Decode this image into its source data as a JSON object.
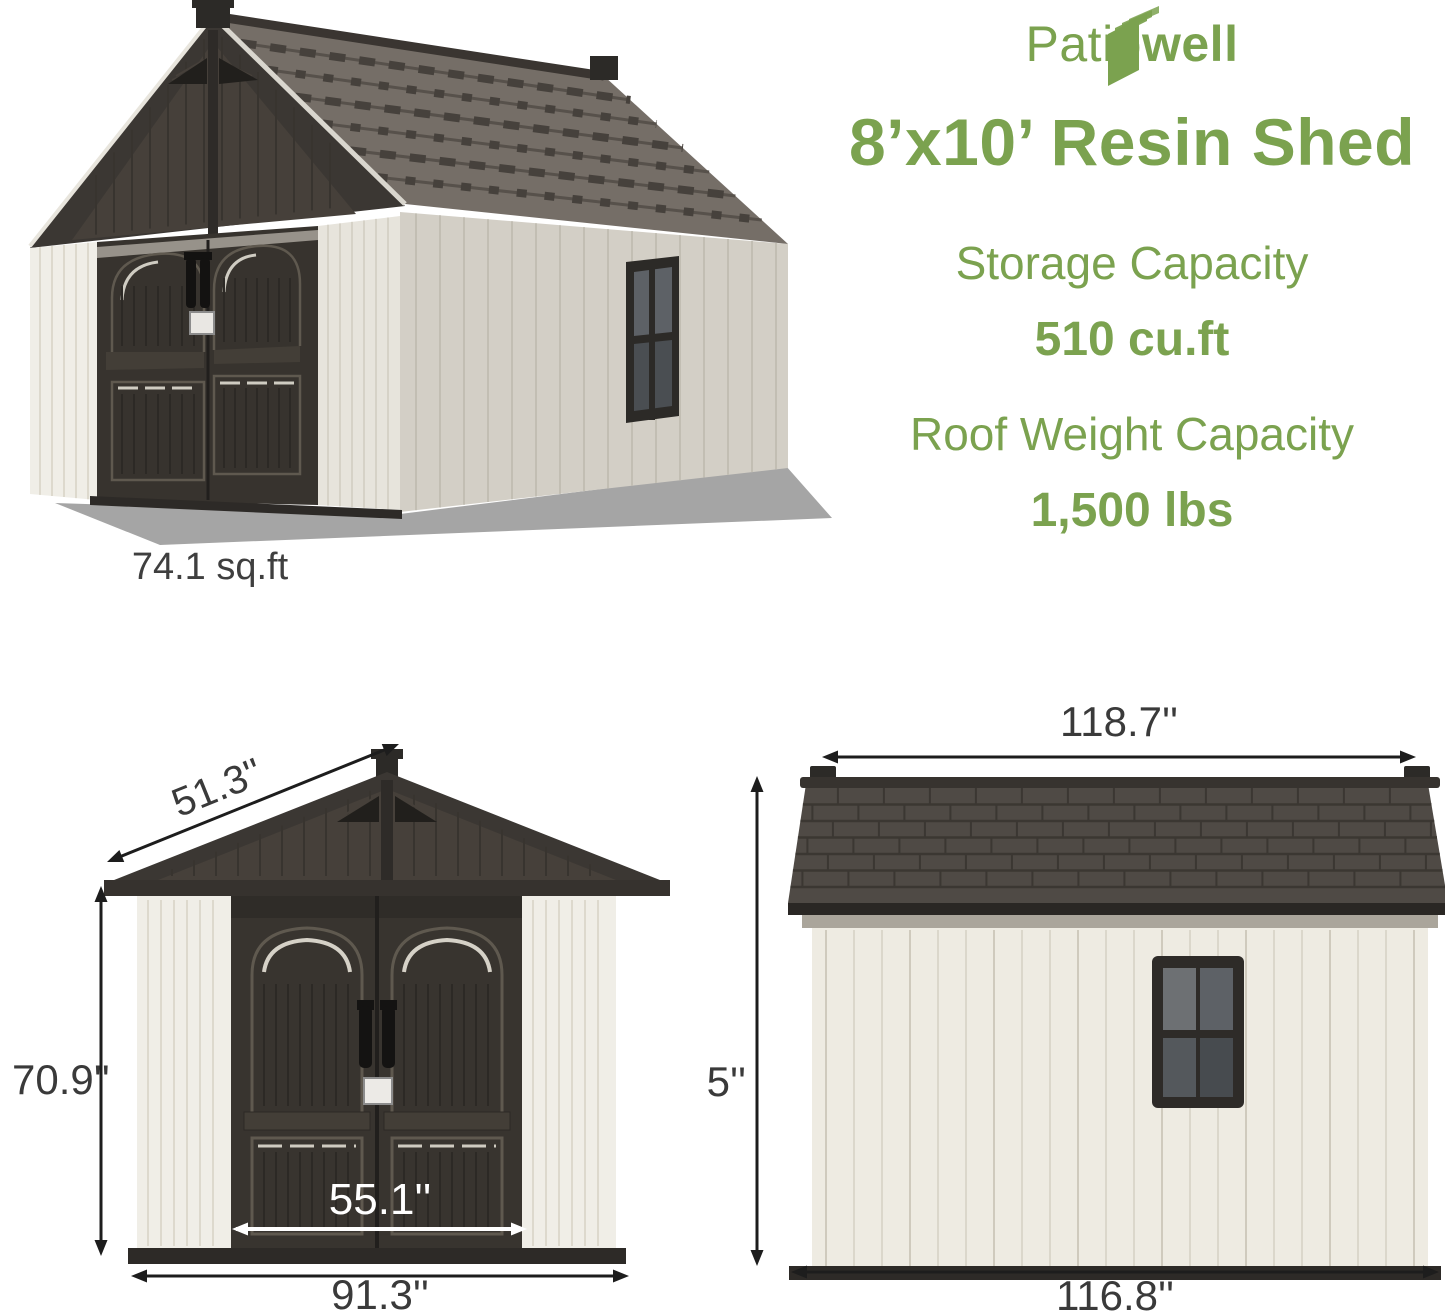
{
  "brand": {
    "name_part1": "Patio",
    "name_part2": "well",
    "logo_icon": "book-pages-icon"
  },
  "header": {
    "title": "8’x10’ Resin Shed"
  },
  "specs": {
    "storage_label": "Storage Capacity",
    "storage_value": "510 cu.ft",
    "roof_label": "Roof Weight Capacity",
    "roof_value": "1,500 lbs"
  },
  "shed_3d": {
    "footprint": "74.1 sq.ft"
  },
  "front_view": {
    "roof_slope_width": "51.3''",
    "wall_height": "70.9''",
    "door_width": "55.1''",
    "base_width": "91.3''"
  },
  "side_view": {
    "roof_length": "118.7''",
    "total_height": "94.5''",
    "base_length": "116.8''"
  },
  "colors": {
    "brand_green": "#7ba24f",
    "dimension_text": "#3a3a3a",
    "roof_dark": "#4f4a45",
    "door_dark": "#37332e",
    "siding_light": "#eeebe2"
  }
}
